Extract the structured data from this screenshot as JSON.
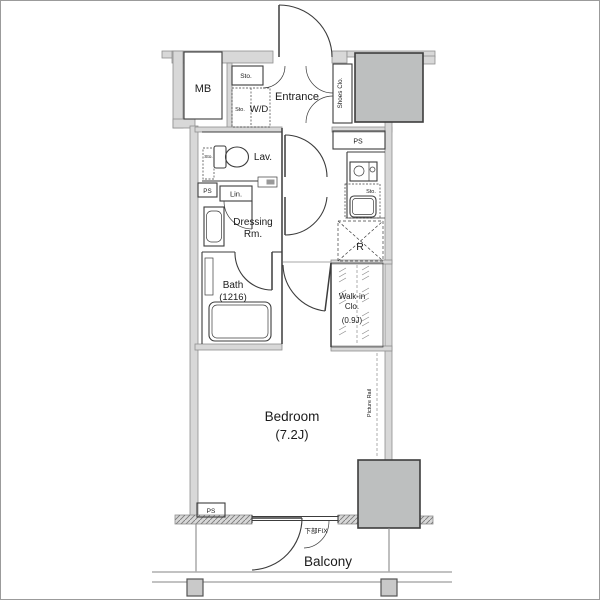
{
  "colors": {
    "wall_fill": "#d8d8d8",
    "wall_stroke": "#8f8f8f",
    "shaft_fill": "#bdbfbf",
    "shaft_stroke": "#3d3d3d",
    "line_dark": "#3c3c3c",
    "line_light": "#8a8a8a"
  },
  "labels": {
    "mb": "MB",
    "entrance_storage": "Sto.",
    "laundry_storage": "Sto.",
    "washer_dryer": "W/D",
    "entrance": "Entrance",
    "shoes_closet": "Shoes Clo.",
    "pipe_space_top": "PS",
    "lavatory": "Lav.",
    "lavatory_storage": "Sto.",
    "pipe_space_left": "PS",
    "linen": "Lin.",
    "dressing_line1": "Dressing",
    "dressing_line2": "Rm.",
    "kitchen_storage": "Sto.",
    "refrigerator": "R",
    "bath_line1": "Bath",
    "bath_line2": "(1216)",
    "walkin_line1": "Walk-in",
    "walkin_line2": "Clo.",
    "walkin_line3": "(0.9J)",
    "bedroom_line1": "Bedroom",
    "bedroom_line2": "(7.2J)",
    "picture_rail": "Picture Rail",
    "pipe_space_bottom": "PS",
    "lower_fix_window": "下部FIX",
    "balcony": "Balcony"
  }
}
